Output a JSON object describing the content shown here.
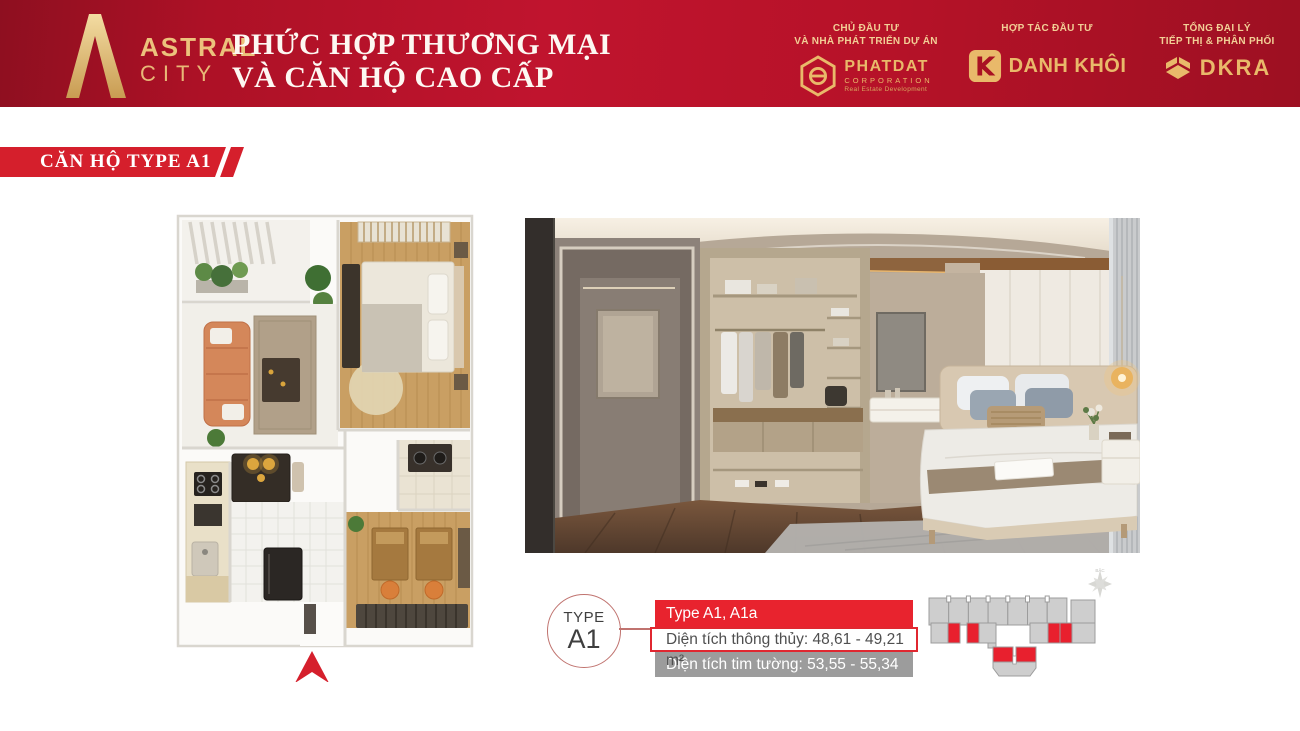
{
  "colors": {
    "header_red": "#b61228",
    "ribbon_red": "#d51f2c",
    "info_red": "#e8232e",
    "gray_bar": "#9c9c9c",
    "gold": "#e9b96a",
    "key_unit_red": "#e8202e",
    "key_unit_gray": "#cecece"
  },
  "header": {
    "logo": {
      "brand": "ASTRAL",
      "brand_sub": "CITY"
    },
    "title_line1": "PHỨC HỢP THƯƠNG MẠI",
    "title_line2": "VÀ CĂN HỘ CAO CẤP",
    "partners": [
      {
        "role_line1": "CHỦ ĐẦU TƯ",
        "role_line2": "VÀ NHÀ PHÁT TRIỂN DỰ ÁN",
        "name": "PHATDAT",
        "name_sub": "CORPORATION",
        "tagline": "Real Estate Development"
      },
      {
        "role_line1": "HỢP TÁC ĐẦU TƯ",
        "role_line2": "",
        "name": "DANH KHÔI"
      },
      {
        "role_line1": "TỔNG ĐẠI LÝ",
        "role_line2": "TIẾP THỊ & PHÂN PHỐI",
        "name": "DKRA"
      }
    ]
  },
  "section": {
    "ribbon_label": "CĂN HỘ TYPE A1"
  },
  "unit_info": {
    "badge_top": "TYPE",
    "badge_bottom": "A1",
    "type_label": "Type A1, A1a",
    "net_area_label": "Diện tích thông thủy: 48,61 - 49,21 m²",
    "gross_area_label": "Diện tích tim tường: 53,55 - 55,34 m²"
  },
  "key_plan": {
    "compass_label": "BẮC"
  }
}
